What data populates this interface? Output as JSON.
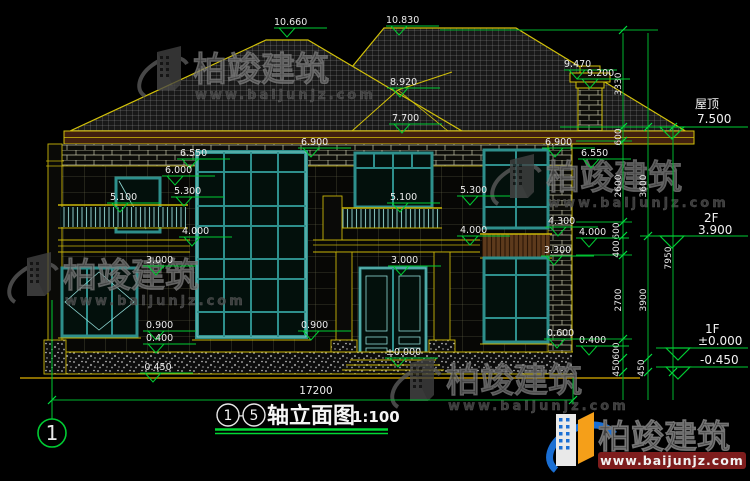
{
  "watermark": {
    "brand": "柏竣建筑",
    "url": "www.baijunjz.com"
  },
  "logo": {
    "brand": "柏竣建筑",
    "url": "www.baijunjz.com"
  },
  "title": {
    "axis_from": "1",
    "separator": "-",
    "axis_to": "5",
    "name": "轴立面图",
    "scale": "1:100"
  },
  "axis_bubble": "1",
  "dims": {
    "total_width": "17200",
    "overall_height": "7950",
    "roof_rise": "3330",
    "chain_a": [
      "600",
      "2600",
      "600",
      "400",
      "2700",
      "600",
      "450"
    ],
    "chain_b": [
      "3600",
      "3900",
      "450"
    ]
  },
  "floors": {
    "roof_label": "屋顶",
    "roof_level": "7.500",
    "f2_label": "2F",
    "f2_level": "3.900",
    "f1_label": "1F",
    "f1_level": "±0.000",
    "f1_below": "-0.450"
  },
  "markers": [
    {
      "v": "10.660"
    },
    {
      "v": "10.830"
    },
    {
      "v": "9.470"
    },
    {
      "v": "9.200"
    },
    {
      "v": "8.920"
    },
    {
      "v": "7.700"
    },
    {
      "v": "6.900"
    },
    {
      "v": "6.900"
    },
    {
      "v": "6.550"
    },
    {
      "v": "6.550"
    },
    {
      "v": "6.000"
    },
    {
      "v": "5.300"
    },
    {
      "v": "5.100"
    },
    {
      "v": "5.100"
    },
    {
      "v": "5.300"
    },
    {
      "v": "4.300"
    },
    {
      "v": "4.000"
    },
    {
      "v": "4.000"
    },
    {
      "v": "4.000"
    },
    {
      "v": "3.300"
    },
    {
      "v": "3.000"
    },
    {
      "v": "3.000"
    },
    {
      "v": "0.900"
    },
    {
      "v": "0.900"
    },
    {
      "v": "0.600"
    },
    {
      "v": "0.400"
    },
    {
      "v": "0.400"
    },
    {
      "v": "±0.000"
    },
    {
      "v": "-0.450"
    }
  ]
}
